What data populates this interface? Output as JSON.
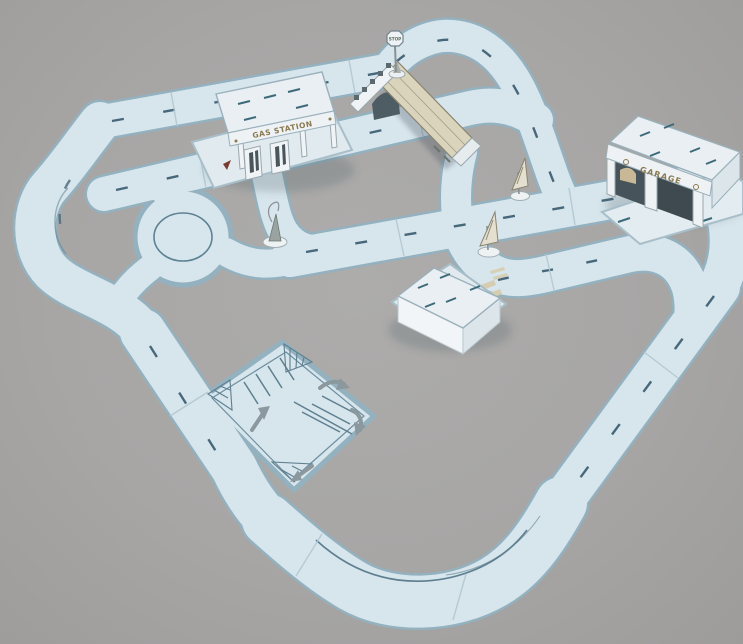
{
  "scene": {
    "name": "toy-road-track-playset-photo",
    "background_color": "#a7a6a5",
    "road_color": "#d7e5ec",
    "road_edge_color": "#93b1bf",
    "road_marking_color": "#47687a",
    "bridge_deck_color": "#dad4bc",
    "building_label_color": "#8a7a50"
  },
  "buildings": {
    "gas_station": {
      "label": "GAS STATION"
    },
    "garage": {
      "label": "GARAGE"
    },
    "house": {
      "label": ""
    }
  },
  "signs": {
    "stop_sign": {
      "label": "STOP"
    }
  },
  "objects": [
    "outer-road-loop",
    "roundabout",
    "gas-station",
    "garage",
    "house",
    "overpass-bridge",
    "stop-sign",
    "traffic-cone",
    "triangle-signpost-center",
    "triangle-signpost-east",
    "parking-lot-plate",
    "pedestrian-crossing"
  ]
}
